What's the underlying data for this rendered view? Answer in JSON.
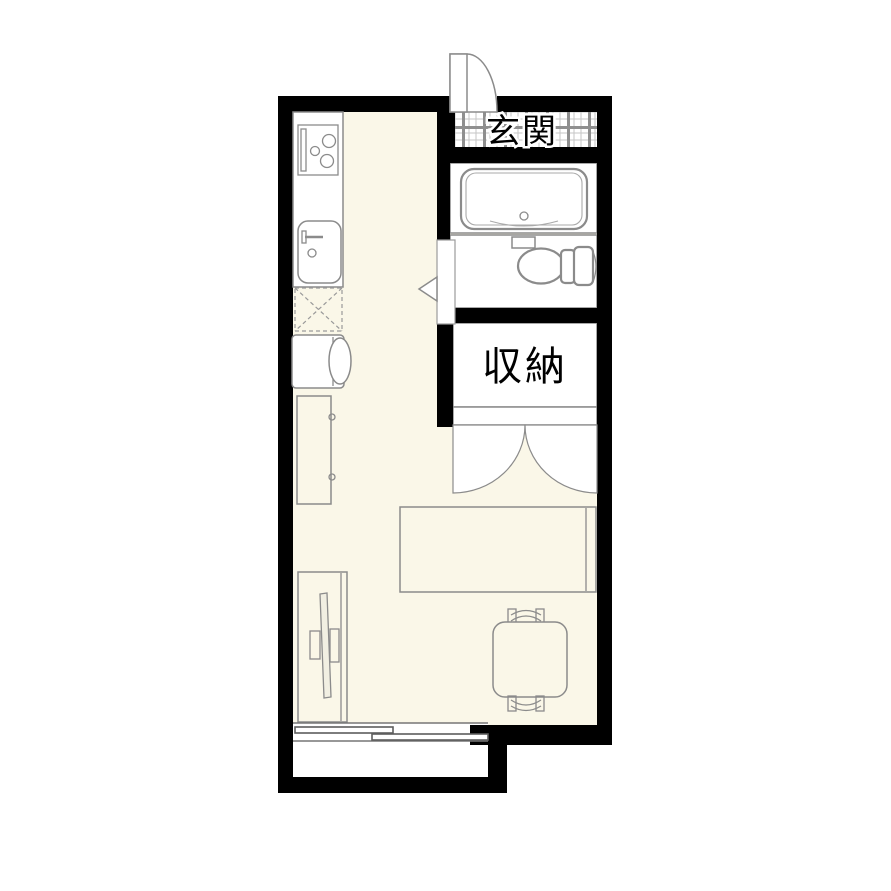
{
  "title": "apartment-floor-plan",
  "labels": {
    "entrance": "玄関",
    "storage": "収納"
  },
  "colors": {
    "wall": "#000000",
    "floor": "#faf7e8",
    "fixture_white": "#ffffff",
    "outline_gray": "#8b8b8b",
    "background": "#ffffff",
    "tile_thin": "#c6c6c6",
    "tile_thick": "#8f8f8f"
  },
  "fixtures": [
    "entrance-door",
    "entrance-tile-floor",
    "bathtub",
    "toilet",
    "toilet-door",
    "storage-closet",
    "storage-double-doors",
    "kitchen-counter",
    "stove",
    "sink",
    "refrigerator-space",
    "washing-machine",
    "cabinet",
    "tv-board",
    "tv",
    "bed",
    "table",
    "chairs",
    "sliding-window",
    "balcony"
  ]
}
